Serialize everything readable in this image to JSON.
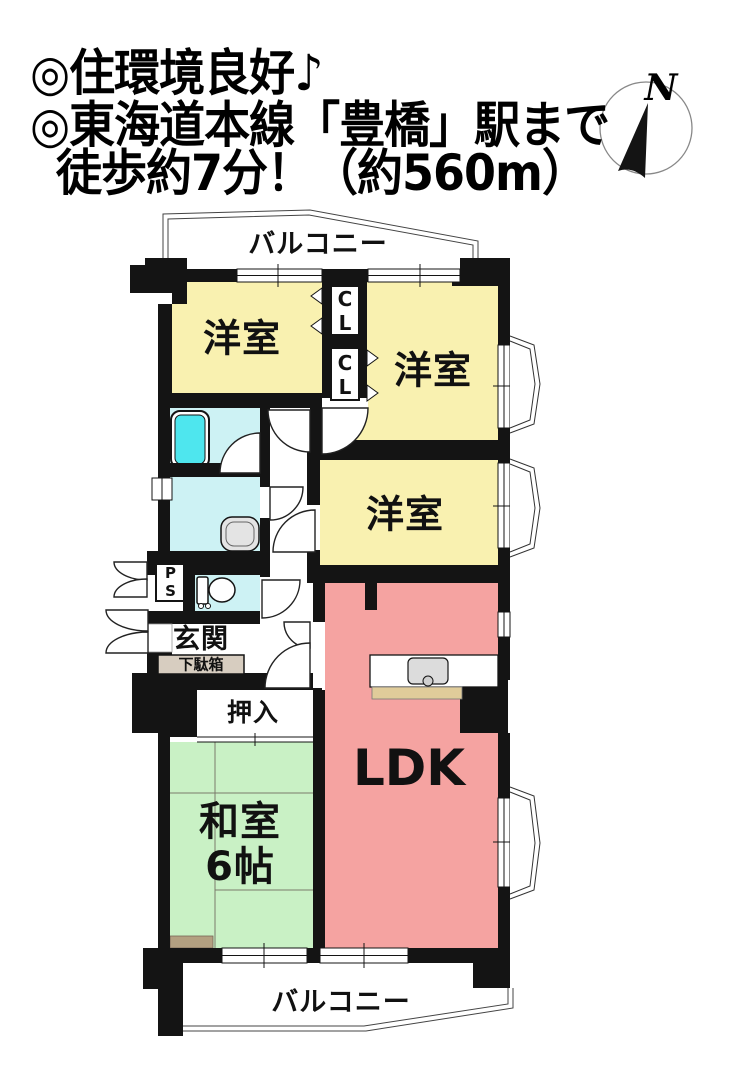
{
  "header": {
    "line1": "◎住環境良好♪",
    "line2": "◎東海道本線「豊橋」駅まで",
    "line3": "徒歩約7分！（約560m）"
  },
  "compass": {
    "label": "N"
  },
  "floor_plan": {
    "balcony_top": "バルコニー",
    "balcony_bottom": "バルコニー",
    "rooms": {
      "western1": "洋室",
      "western2": "洋室",
      "western3": "洋室",
      "ldk": "LDK",
      "japanese": "和室\n6帖",
      "entrance": "玄関",
      "shoe_cabinet": "下駄箱",
      "oshiire": "押入",
      "closet1": "CL",
      "closet2": "CL",
      "pipe_shaft": "PS"
    },
    "colors": {
      "room_yellow": "#f9f1b0",
      "room_pink": "#f5a3a1",
      "room_green": "#c9f1c5",
      "wet_cyan": "#cdf2f4",
      "tub_cyan": "#4ee6ee",
      "shoe_tan": "#d7cdc0",
      "counter_tan": "#e0cc9a",
      "strip_tan": "#b3a081",
      "wall_black": "#141414"
    }
  }
}
